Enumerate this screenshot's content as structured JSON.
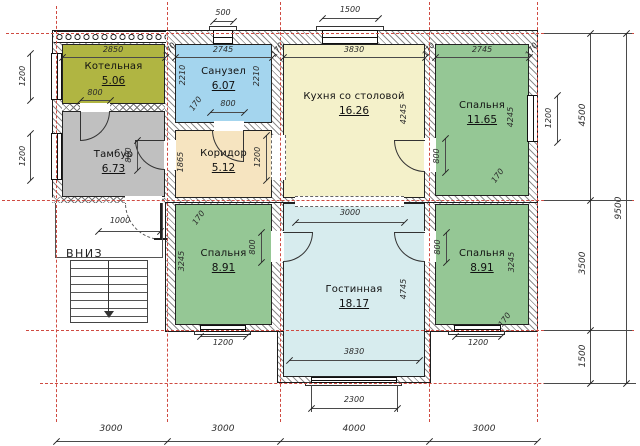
{
  "rooms": [
    {
      "name": "Котельная",
      "area": "5.06",
      "color": "#b0b542"
    },
    {
      "name": "Санузел",
      "area": "6.07",
      "color": "#a4d5ee"
    },
    {
      "name": "Кухня со столовой",
      "area": "16.26",
      "color": "#f4f1ca"
    },
    {
      "name": "Спальня",
      "area": "11.65",
      "color": "#95c795"
    },
    {
      "name": "Тамбур",
      "area": "6.73",
      "color": "#c0c0c0"
    },
    {
      "name": "Коридор",
      "area": "5.12",
      "color": "#f6e4c0"
    },
    {
      "name": "Спальня",
      "area": "8.91",
      "color": "#95c795"
    },
    {
      "name": "Гостинная",
      "area": "18.17",
      "color": "#d7ecee"
    },
    {
      "name": "Спальня",
      "area": "8.91",
      "color": "#95c795"
    }
  ],
  "stairs": {
    "label": "ВНИЗ",
    "arrow_icon": "down-arrow"
  },
  "dims": {
    "wall": "170",
    "door": "800",
    "entry_door": "1000",
    "window_std": "1200",
    "koridor_opening": "1200",
    "window_small": "500",
    "window_kitchen": "1500",
    "kotelnaya_w": "2850",
    "sanuzel_w": "2745",
    "bedroom_right_w": "2745",
    "kitchen_w": "3830",
    "living_w": "3830",
    "sanuzel_d": "2210",
    "koridor_d": "1865",
    "kitchen_d": "4245",
    "bedroom_right_d": "4245",
    "bedroom_d": "3245",
    "living_opening": "3000",
    "living_d": "4745",
    "living_window": "2300",
    "bottom": [
      "3000",
      "3000",
      "4000",
      "3000"
    ],
    "right": {
      "r1": "4500",
      "r2": "3500",
      "r3": "1500",
      "total": "9500"
    }
  },
  "colors": {
    "grid_axis": "#cf4a41",
    "wall_hatch": "#8d8d8d"
  }
}
